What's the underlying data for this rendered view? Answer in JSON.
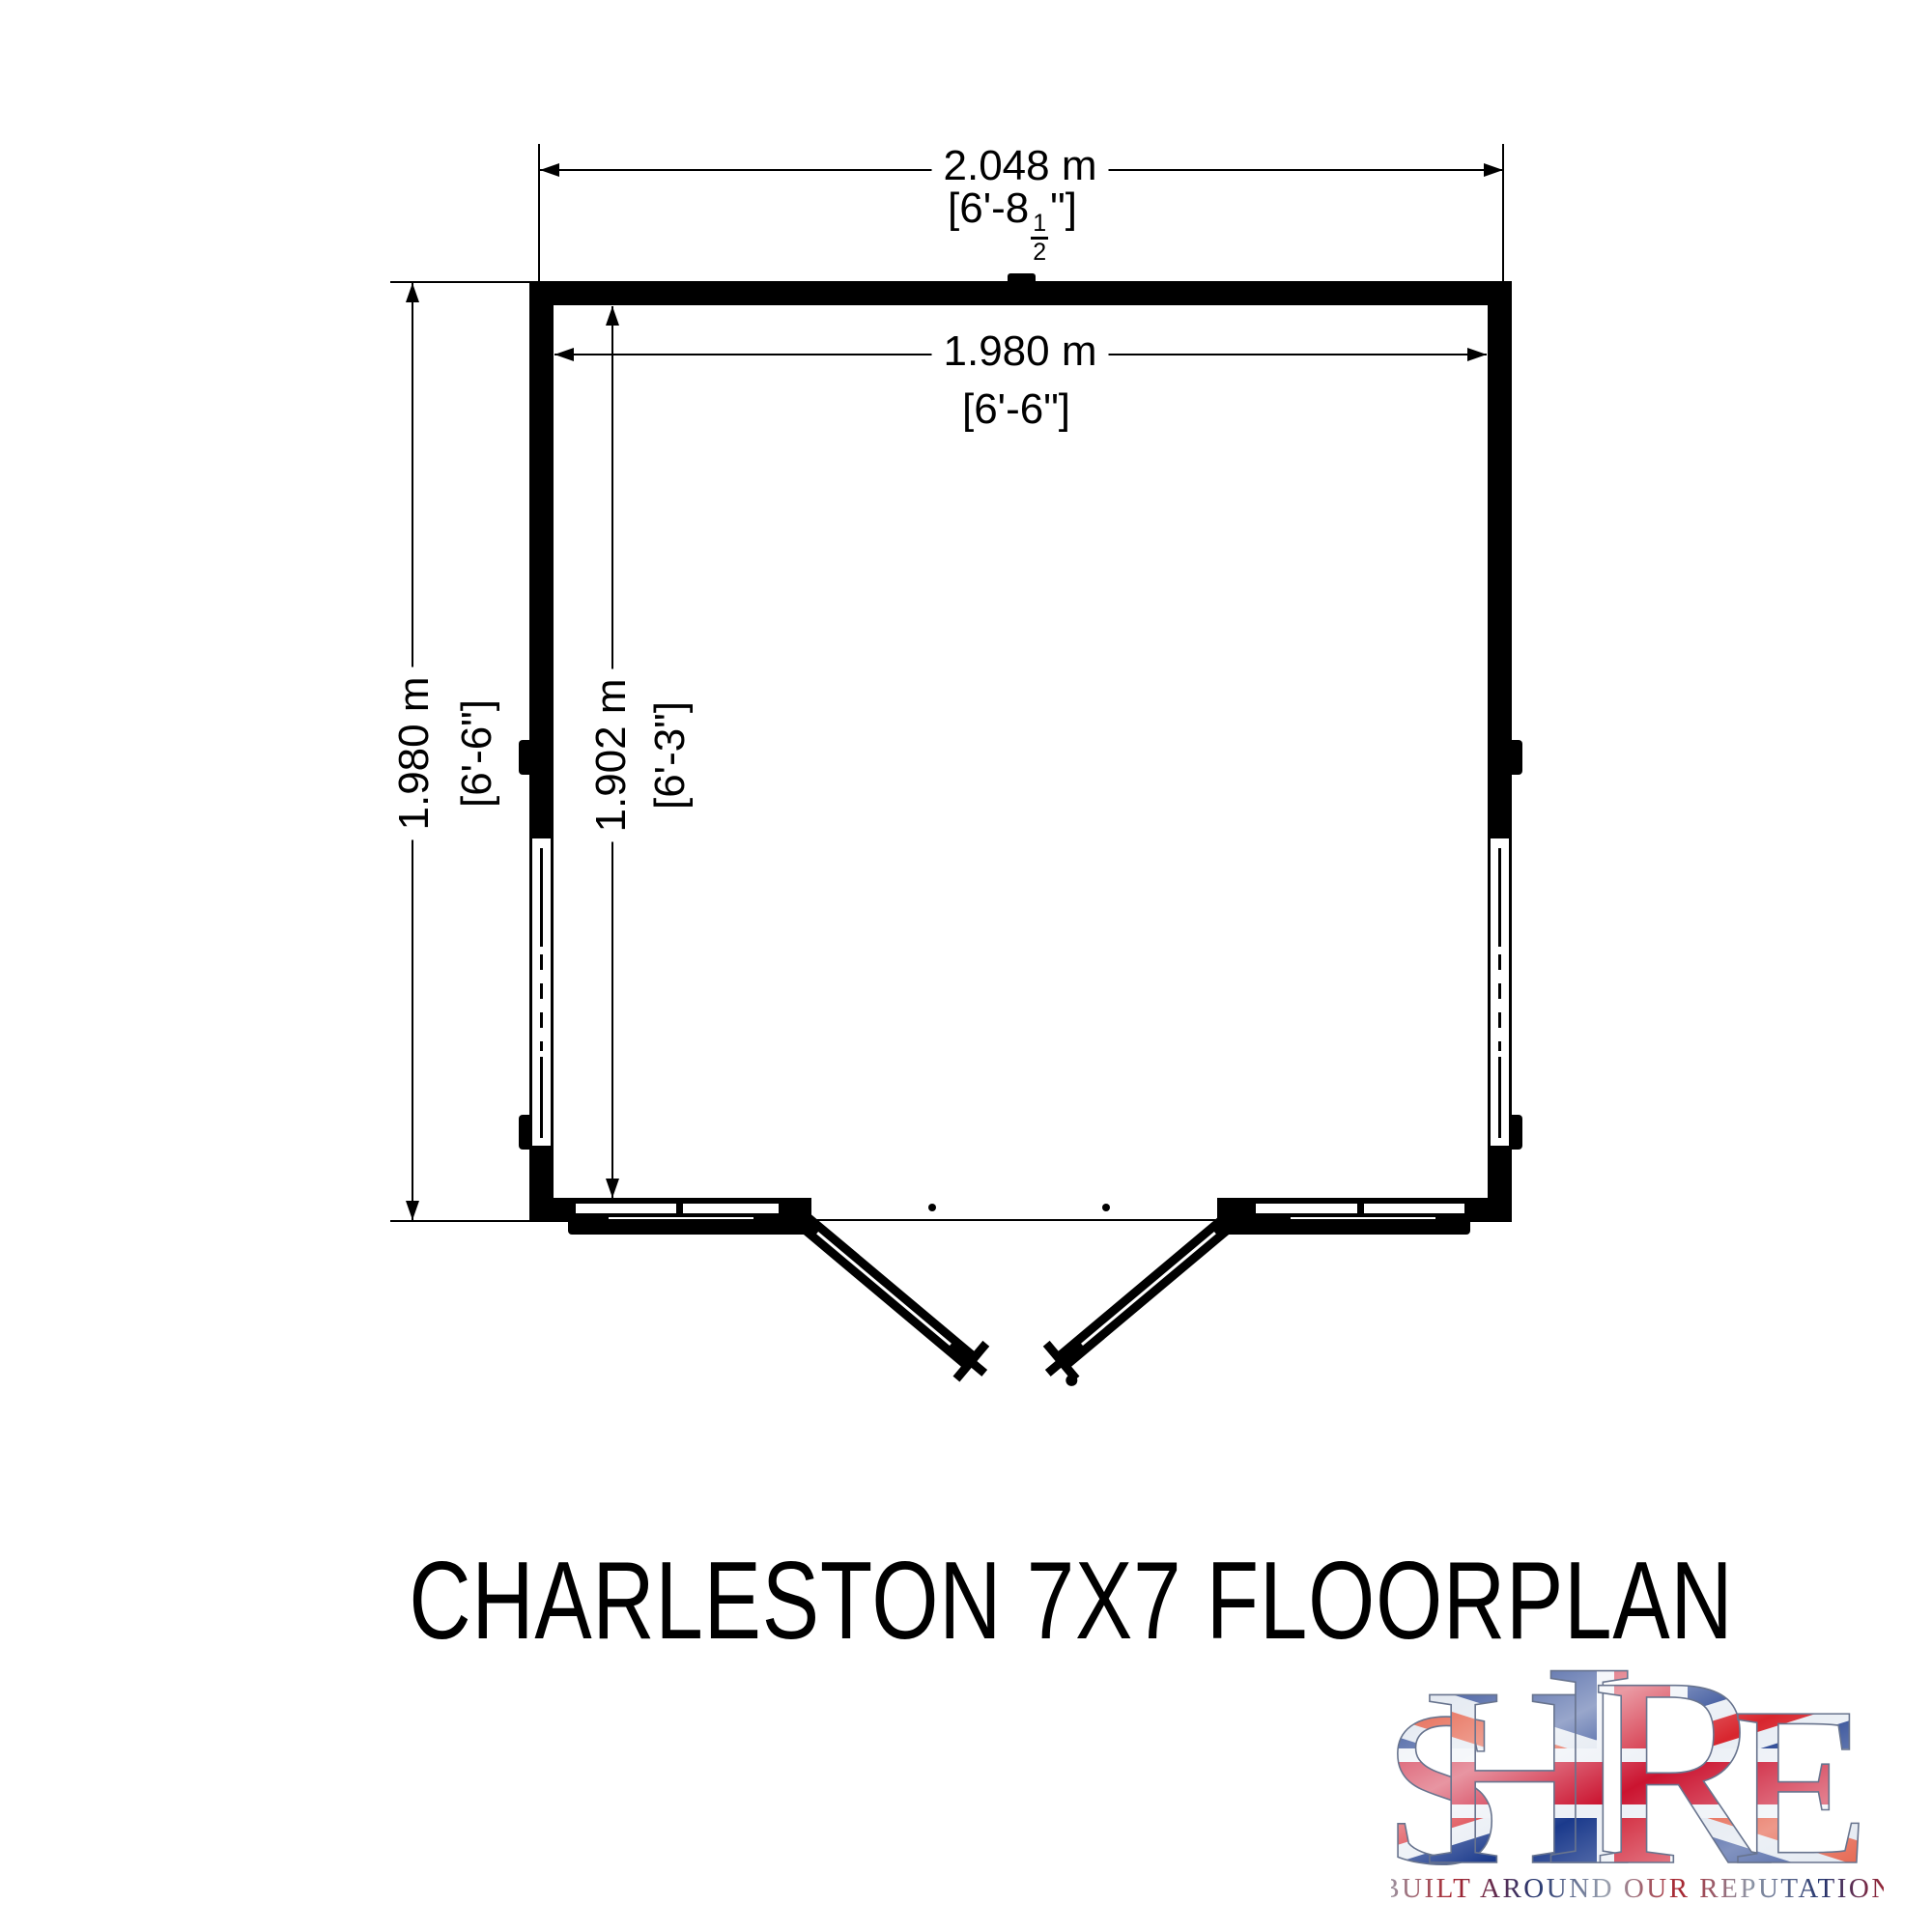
{
  "title": "CHARLESTON 7X7 FLOORPLAN",
  "dims": {
    "top_outer": {
      "metric": "2.048 m",
      "imp_prefix": "[6'-8",
      "frac_n": "1",
      "frac_d": "2",
      "imp_suffix": "\"]"
    },
    "top_inner": {
      "metric": "1.980 m",
      "imperial": "[6'-6\"]"
    },
    "left_outer": {
      "metric": "1.980 m",
      "imperial": "[6'-6\"]"
    },
    "left_inner": {
      "metric": "1.902 m",
      "imperial": "[6'-3\"]"
    }
  },
  "logo": {
    "brand": "SHIRE",
    "letters": [
      "S",
      "H",
      "I",
      "R",
      "E"
    ],
    "tagline": "BUILT AROUND OUR REPUTATION"
  },
  "colors": {
    "ink": "#000000",
    "flag_blue": "#1b3a8c",
    "flag_red": "#d01f34",
    "flag_white": "#ecf0f6",
    "tagline_navy": "#24356e",
    "tagline_red": "#a8242e",
    "tagline_silver": "#9aa2b0"
  }
}
